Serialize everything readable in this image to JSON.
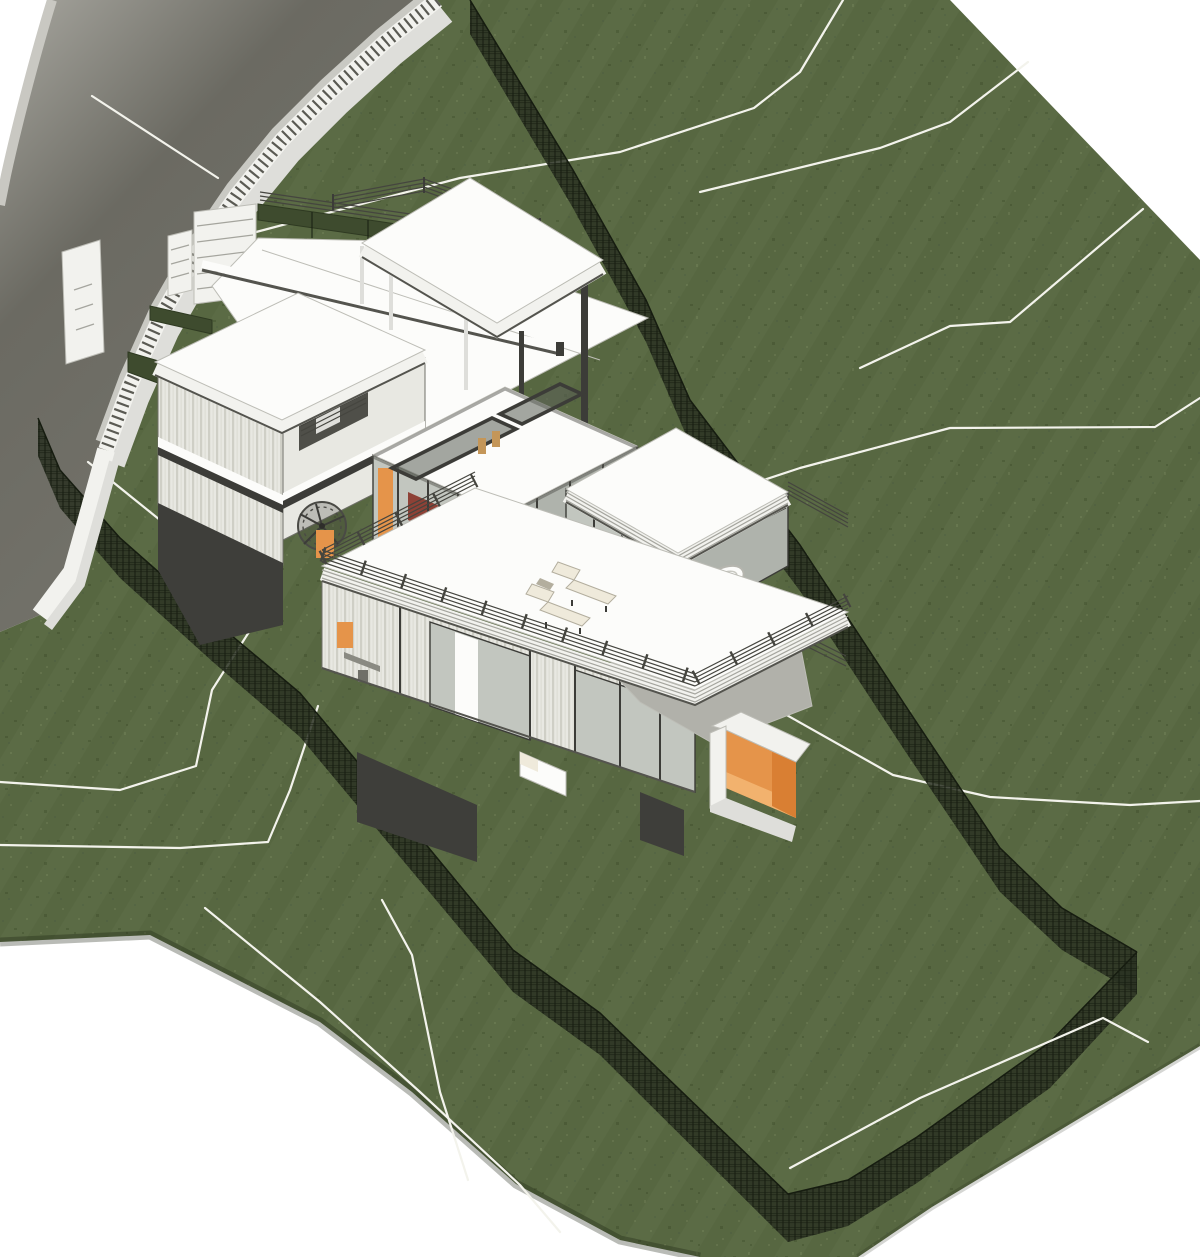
{
  "scene": {
    "description": "Aerial axonometric 3D architectural rendering of a modern multi-level hillside house on a sloping grass site, with white terrain contour lines, dark mesh boundary fences, a curved gray road and a white retaining wall with picket fence along the upper-left edge",
    "view": "3D shaded site view",
    "elements": {
      "road": "curved road with retaining wall",
      "picket_fence": "white picket fence on retaining wall",
      "entry_gate": "louvered entry gate",
      "hedges": "clipped hedge strips at entry",
      "site": "sloping lawn with mowing stripes",
      "contours": "white terrain contour lines",
      "boundary_fence": "dark wire-mesh site boundary fence",
      "canopy": "floating flat canopy roof on slim posts",
      "tower": "two-storey clad tower with balcony",
      "pavilion": "glass living pavilion with roof skylights, red sofas, yellow coffee table and bar stools",
      "bathroom_wing": "flat-roofed wing with freestanding bathtub and toilet",
      "roof_terrace": "large roof deck with two chaise lounges",
      "spiral_stair": "dark spiral staircase",
      "bedroom_wing": "lower glazed bedroom wing with bed and desk",
      "walkway": "gray access ramp",
      "entry_box": "orange-lined entry portal box"
    }
  },
  "colors": {
    "white": "#ffffff",
    "grass": "#5b6b45",
    "grassDark": "#4f5f3a",
    "grassMid": "#556644",
    "grassLight": "#67774f",
    "mowStripe": "rgba(10,20,4,0.05)",
    "roadLight": "#a8a7a0",
    "roadMid": "#73726a",
    "roadDark": "#6b6a62",
    "verge": "#c9c8c2",
    "curb": "#c9c9c3",
    "contour": "#f3f3ec",
    "wallWhite": "#f2f2ee",
    "wallShade": "#dededa",
    "picket": "#5a5a53",
    "fence": "#2a3122",
    "fenceLine": "#161c10",
    "hedge": "#3e4b2e",
    "hedgeLine": "#2e3921",
    "roofWhite": "#fcfcfa",
    "roofEdge": "#bdbdb6",
    "fasciaLight": "#ececE7",
    "frameDark": "#3c3c38",
    "frameMid": "#6f6f68",
    "frameShadow": "#54544e",
    "louver": "#a5a59e",
    "glass": "#c2c6bf",
    "glassDark": "#afb3ac",
    "cladBase": "#e8e8e2",
    "cladLine": "#cfcfc6",
    "cladLine2": "#dcdcd4",
    "charcoal": "#3e3e3a",
    "railDark": "#45453f",
    "walkGray": "#b1b1aa",
    "orange": "#e5944a",
    "orangeDark": "#d97f33",
    "orangeLight": "#f2b26e",
    "sofa": "#8e4136",
    "tableYellow": "#f1e386",
    "wood": "#c49658",
    "cushion": "#efeadb",
    "cushionEdge": "#b3ae9e",
    "shadowGreen": "rgba(22,30,12,0.30)"
  }
}
